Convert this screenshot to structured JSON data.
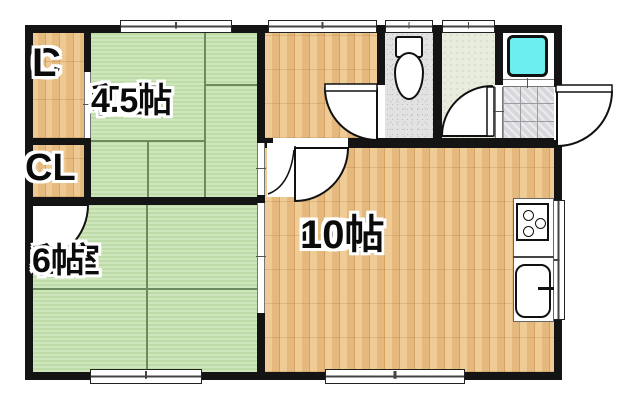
{
  "floorplan": {
    "rooms": {
      "washitsu_45": {
        "name": "和室",
        "size": "4.5帖"
      },
      "washitsu_6": {
        "name": "和室",
        "size": "6帖"
      },
      "ldk": {
        "name": "LDK",
        "size": "10帖"
      },
      "closet_upper": {
        "line1": "C",
        "line2": "L"
      },
      "closet_lower": {
        "label": "CL"
      }
    },
    "fixtures": {
      "toilet": "toilet",
      "bathtub": "bathtub",
      "stove": "3-burner-stove",
      "sink": "kitchen-sink",
      "entrance": "genkan-tile-entry"
    },
    "colors": {
      "tatami": "#bedca8",
      "tatami_light": "#cfe6bc",
      "tatami_line": "#6b8a5e",
      "wood": "#e6bb80",
      "wall": "#141414",
      "bathtub_fill": "#6ceef0",
      "tile": "#d8d8dc"
    }
  }
}
